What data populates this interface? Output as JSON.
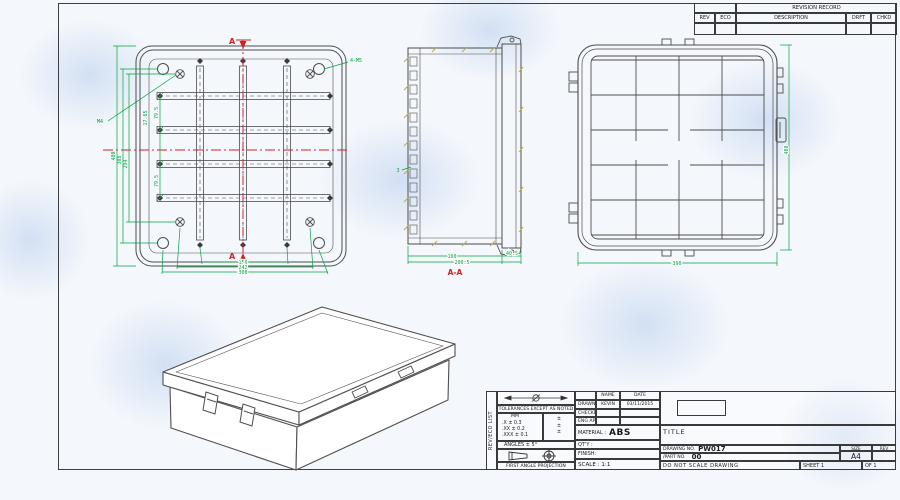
{
  "colors": {
    "dim": "#00a63c",
    "section": "#d42020",
    "line": "#4d4d4d",
    "hatch": "#c4b00c",
    "paper": "#f4f7fc"
  },
  "revision": {
    "title": "REVISION RECORD",
    "col_rev": "REV",
    "col_eco": "ECO",
    "col_desc": "DESCRIPTION",
    "col_drft": "DRFT",
    "col_chkd": "CHKD"
  },
  "front": {
    "section_top": "A",
    "section_bottom": "A",
    "callout_m5": "4-M5",
    "callout_m4": "M4",
    "dim_overall_h": "480",
    "dim_mid_h": "308",
    "dim_inner_h": "294",
    "dim_sp1": "79.5",
    "dim_sp2": "79.5",
    "dim_offset": "17.65",
    "dim_b1": "150",
    "dim_b2": "242",
    "dim_b3": "308"
  },
  "side": {
    "label": "A-A",
    "dim_body": "160",
    "dim_total": "200.5",
    "dim_lid": "40.5",
    "dim_wall": "3"
  },
  "rear": {
    "dim_w": "390",
    "dim_h": "400"
  },
  "title_block": {
    "side_label": "REV/ECO LIST",
    "tol_header": "TOLERANCES EXCEPT AS NOTED",
    "tol_unit": "MM",
    "tol_x": ".X ± 0.3",
    "tol_xx": ".XX ± 0.2",
    "tol_xxx": ".XXX ± 0.1",
    "tol_in1": "±",
    "tol_in2": "±",
    "tol_in3": "±",
    "angles": "ANGLES ± 5°",
    "projection": "FIRST ANGLE PROJECTION",
    "name_h": "NAME",
    "date_h": "DATE",
    "drawn": "DRAWN",
    "drawn_name": "KEVIN",
    "drawn_date": "03/11/2015",
    "checked": "CHECKED",
    "eng_appr": "ENG APPR",
    "material_label": "MATERIAL :",
    "material": "ABS",
    "qty": "QT'Y :",
    "finish": "FINISH:",
    "scale": "SCALE : 1:1",
    "title_label": "TITLE",
    "dwg_label": "DRAWING NO.",
    "dwg_no": "PW017",
    "part_label": "/PART NO.",
    "part_no": "00",
    "size_label": "SIZE",
    "size": "A4",
    "rev_label": "REV",
    "note": "DO NOT SCALE DRAWING",
    "sheet": "SHEET 1",
    "of": "OF 1"
  }
}
